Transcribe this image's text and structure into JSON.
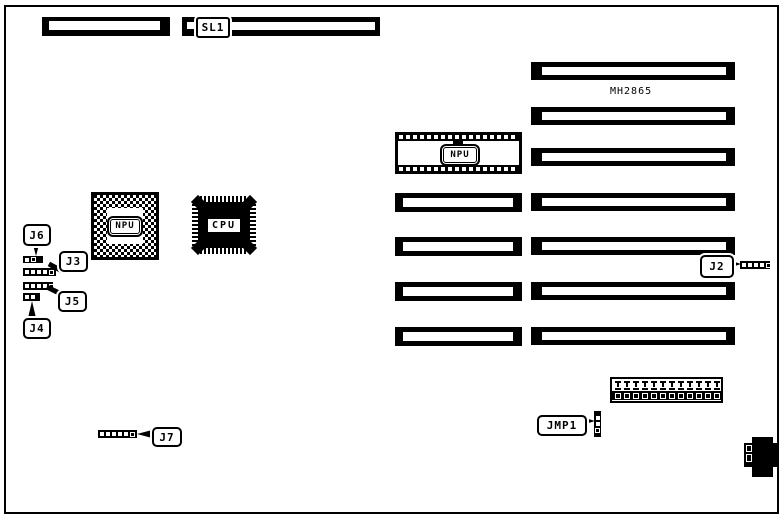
{
  "colors": {
    "ink": "#000000",
    "paper": "#ffffff"
  },
  "diagram": {
    "labels": {
      "sl1": "SL1",
      "board_chip": "MH2865",
      "npu_socket": "NPU",
      "npu_chip": "NPU",
      "cpu_chip": "CPU"
    },
    "jumpers": {
      "j2": {
        "label": "J2",
        "cells": [
          "f",
          "f",
          "f",
          "f",
          "o"
        ]
      },
      "j3": {
        "label": "J3",
        "cells": [
          "f",
          "f",
          "f",
          "f",
          "o"
        ]
      },
      "j4": {
        "label": "J4",
        "cells": [
          "f",
          "f"
        ]
      },
      "j5": {
        "label": "J5",
        "cells": [
          "f",
          "f",
          "f",
          "f",
          "o"
        ]
      },
      "j6": {
        "label": "J6",
        "cells": [
          "f",
          "o"
        ]
      },
      "j7": {
        "label": "J7",
        "cells": [
          "f",
          "f",
          "f",
          "f",
          "f",
          "o"
        ]
      },
      "jmp1": {
        "label": "JMP1",
        "cells": [
          "f",
          "f",
          "o"
        ]
      }
    },
    "pin_block": {
      "positions": 12
    }
  }
}
